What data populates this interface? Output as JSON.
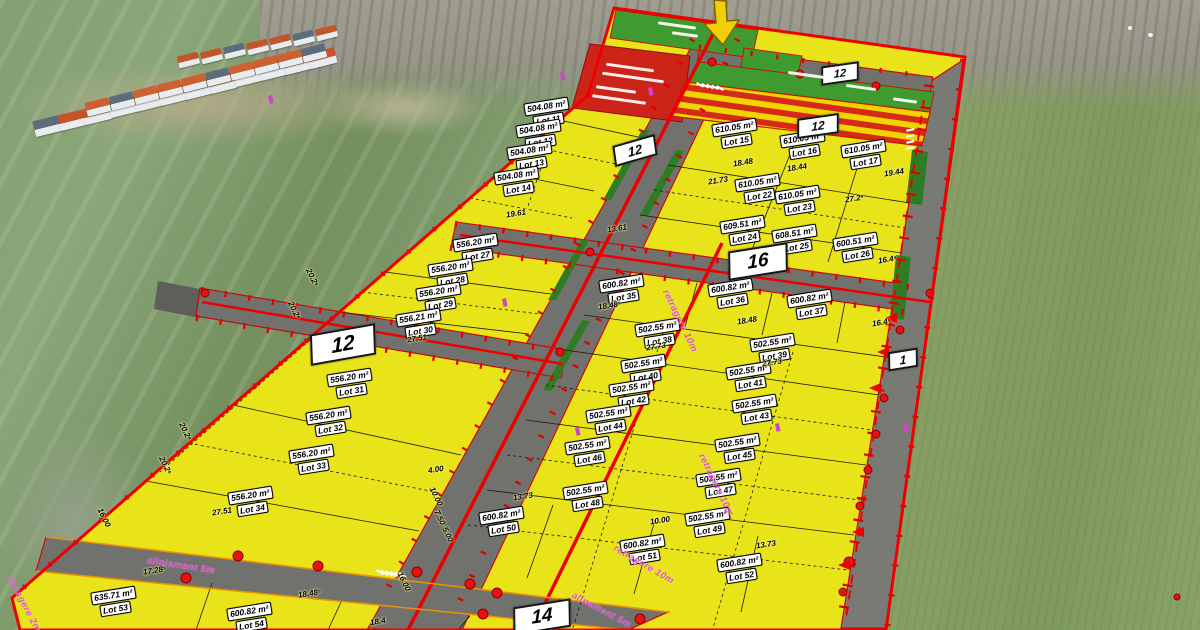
{
  "map": {
    "lots": [
      {
        "area": "504.08 m²",
        "lot": "Lot 11"
      },
      {
        "area": "504.08 m²",
        "lot": "Lot 12"
      },
      {
        "area": "504.08 m²",
        "lot": "Lot 13"
      },
      {
        "area": "504.08 m²",
        "lot": "Lot 14"
      },
      {
        "area": "610.05 m²",
        "lot": "Lot 15"
      },
      {
        "area": "610.05 m²",
        "lot": "Lot 16"
      },
      {
        "area": "610.05 m²",
        "lot": "Lot 17"
      },
      {
        "area": "610.05 m²",
        "lot": "Lot 22"
      },
      {
        "area": "610.05 m²",
        "lot": "Lot 23"
      },
      {
        "area": "609.51 m²",
        "lot": "Lot 24"
      },
      {
        "area": "608.51 m²",
        "lot": "Lot 25"
      },
      {
        "area": "600.51 m²",
        "lot": "Lot 26"
      },
      {
        "area": "556.20 m²",
        "lot": "Lot 27"
      },
      {
        "area": "556.20 m²",
        "lot": "Lot 28"
      },
      {
        "area": "556.20 m²",
        "lot": "Lot 29"
      },
      {
        "area": "556.21 m²",
        "lot": "Lot 30"
      },
      {
        "area": "556.20 m²",
        "lot": "Lot 31"
      },
      {
        "area": "556.20 m²",
        "lot": "Lot 32"
      },
      {
        "area": "556.20 m²",
        "lot": "Lot 33"
      },
      {
        "area": "556.20 m²",
        "lot": "Lot 34"
      },
      {
        "area": "600.82 m²",
        "lot": "Lot 35"
      },
      {
        "area": "600.82 m²",
        "lot": "Lot 36"
      },
      {
        "area": "600.82 m²",
        "lot": "Lot 37"
      },
      {
        "area": "502.55 m²",
        "lot": "Lot 38"
      },
      {
        "area": "502.55 m²",
        "lot": "Lot 39"
      },
      {
        "area": "502.55 m²",
        "lot": "Lot 40"
      },
      {
        "area": "502.55 m²",
        "lot": "Lot 41"
      },
      {
        "area": "502.55 m²",
        "lot": "Lot 42"
      },
      {
        "area": "502.55 m²",
        "lot": "Lot 43"
      },
      {
        "area": "502.55 m²",
        "lot": "Lot 44"
      },
      {
        "area": "502.55 m²",
        "lot": "Lot 45"
      },
      {
        "area": "502.55 m²",
        "lot": "Lot 46"
      },
      {
        "area": "502.55 m²",
        "lot": "Lot 47"
      },
      {
        "area": "502.55 m²",
        "lot": "Lot 48"
      },
      {
        "area": "502.55 m²",
        "lot": "Lot 49"
      },
      {
        "area": "600.82 m²",
        "lot": "Lot 50"
      },
      {
        "area": "600.82 m²",
        "lot": "Lot 51"
      },
      {
        "area": "600.82 m²",
        "lot": "Lot 52"
      },
      {
        "area": "635.71 m²",
        "lot": "Lot 53"
      },
      {
        "area": "600.82 m²",
        "lot": "Lot 54"
      }
    ],
    "dims": [
      {
        "text": "19.61"
      },
      {
        "text": "13.61"
      },
      {
        "text": "18.48"
      },
      {
        "text": "18.44"
      },
      {
        "text": "19.44"
      },
      {
        "text": "21.73"
      },
      {
        "text": "27.2⁵"
      },
      {
        "text": "18.48"
      },
      {
        "text": "16.4⁵"
      },
      {
        "text": "27.51"
      },
      {
        "text": "27.51"
      },
      {
        "text": "18.48⁵"
      },
      {
        "text": "18.48"
      },
      {
        "text": "16.4⁵"
      },
      {
        "text": "27.73"
      },
      {
        "text": "27.73"
      },
      {
        "text": "13.73"
      },
      {
        "text": "10.00"
      },
      {
        "text": "13.73"
      },
      {
        "text": "4.00"
      },
      {
        "text": "17.28⁵"
      },
      {
        "text": "18.48⁵"
      },
      {
        "text": "18.4"
      },
      {
        "text": "20.2⁵"
      },
      {
        "text": "20.2⁵"
      },
      {
        "text": "20.2⁵"
      },
      {
        "text": "20.2⁵"
      },
      {
        "text": "16.00"
      },
      {
        "text": "16.00"
      },
      {
        "text": "7.50"
      },
      {
        "text": "5.00"
      },
      {
        "text": "10.00"
      }
    ],
    "setback_labels": [
      {
        "text": "retragere 10m"
      },
      {
        "text": "alinament 5m"
      },
      {
        "text": "aliniament 5m"
      },
      {
        "text": "retragere 2m"
      },
      {
        "text": "retragere 10m"
      },
      {
        "text": "retragere 10m"
      }
    ],
    "badges": [
      {
        "text": "12"
      },
      {
        "text": "12"
      },
      {
        "text": "12"
      },
      {
        "text": "12"
      },
      {
        "text": "16"
      },
      {
        "text": "1"
      },
      {
        "text": "14"
      }
    ],
    "colors": {
      "lot_fill": "#e9e41a",
      "road": "#71716d",
      "boundary_red": "#ee0000",
      "green_zone": "#3f9b30",
      "red_zone": "#cc2418",
      "hatch_red": "#d62a18",
      "hatch_yellow": "#f0d400",
      "setback_pink": "#dd55cc",
      "arrow_yellow": "#f0cf08",
      "orange_edge": "#e8920a"
    }
  }
}
